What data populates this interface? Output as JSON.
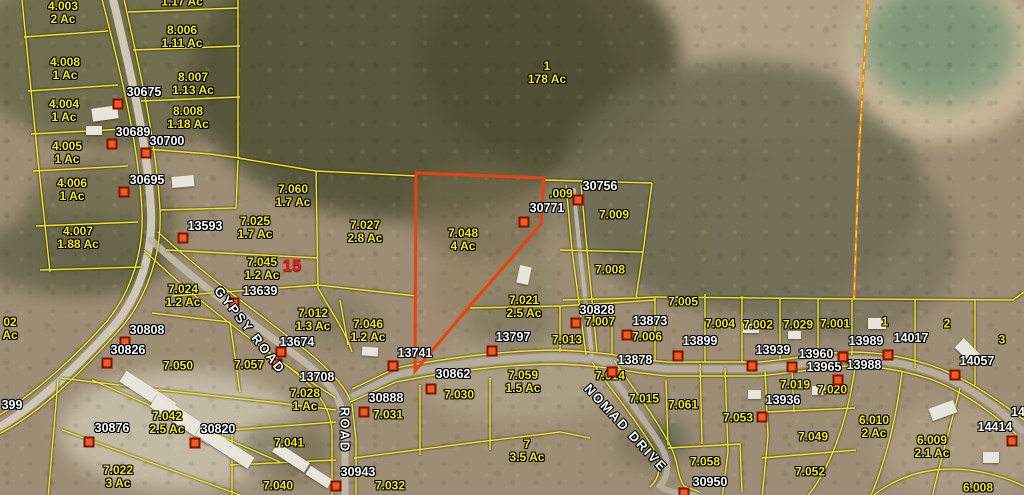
{
  "map": {
    "type": "county-gis-parcel-viewer",
    "highlight": {
      "parcel_num": "7.048",
      "outline_color": "#e8430e"
    },
    "colors": {
      "parcel_line": "#f0e822",
      "parcel_label": "#f6ee00",
      "id_label": "#ffffff",
      "marker_fill": "#f15b1e",
      "marker_border": "#7c1200",
      "route_label": "#ff1010",
      "section_line": "#e8821e",
      "pond": "#8ba081"
    },
    "parcels": [
      {
        "num": "4.003",
        "acres": "2 Ac",
        "x": 63,
        "y": 6
      },
      {
        "num": "4.008",
        "acres": "1 Ac",
        "x": 65,
        "y": 62
      },
      {
        "num": "4.004",
        "acres": "1 Ac",
        "x": 64,
        "y": 104
      },
      {
        "num": "4.005",
        "acres": "1 Ac",
        "x": 67,
        "y": 146
      },
      {
        "num": "4.006",
        "acres": "1 Ac",
        "x": 72,
        "y": 183
      },
      {
        "num": "4.007",
        "acres": "1.88 Ac",
        "x": 78,
        "y": 231
      },
      {
        "num": "",
        "acres": "1.17 Ac",
        "x": 182,
        "y": 2
      },
      {
        "num": "8.006",
        "acres": "1.11 Ac",
        "x": 182,
        "y": 30
      },
      {
        "num": "8.007",
        "acres": "1.13 Ac",
        "x": 193,
        "y": 77
      },
      {
        "num": "8.008",
        "acres": "1.18 Ac",
        "x": 188,
        "y": 111
      },
      {
        "num": "1",
        "acres": "178 Ac",
        "x": 547,
        "y": 66
      },
      {
        "num": "7.060",
        "acres": "1.7 Ac",
        "x": 293,
        "y": 189
      },
      {
        "num": "7.025",
        "acres": "1.7 Ac",
        "x": 255,
        "y": 221
      },
      {
        "num": "7.027",
        "acres": "2.8 Ac",
        "x": 365,
        "y": 225
      },
      {
        "num": "7.045",
        "acres": "1.2 Ac",
        "x": 262,
        "y": 262
      },
      {
        "num": "7.024",
        "acres": "1.2 Ac",
        "x": 183,
        "y": 289
      },
      {
        "num": "7.012",
        "acres": "1.3 Ac",
        "x": 313,
        "y": 313
      },
      {
        "num": "7.046",
        "acres": "1.2 Ac",
        "x": 368,
        "y": 324
      },
      {
        "num": "7.048",
        "acres": "4 Ac",
        "x": 463,
        "y": 233
      },
      {
        "num": "7.021",
        "acres": "2.5 Ac",
        "x": 524,
        "y": 300
      },
      {
        "num": ".009",
        "acres": "",
        "x": 561,
        "y": 194
      },
      {
        "num": "7.009",
        "acres": "",
        "x": 614,
        "y": 215
      },
      {
        "num": "7.008",
        "acres": "",
        "x": 610,
        "y": 270
      },
      {
        "num": "7.007",
        "acres": "",
        "x": 600,
        "y": 322
      },
      {
        "num": "7.006",
        "acres": "",
        "x": 647,
        "y": 337
      },
      {
        "num": "7.005",
        "acres": "",
        "x": 683,
        "y": 302
      },
      {
        "num": "7.004",
        "acres": "",
        "x": 720,
        "y": 324
      },
      {
        "num": "7.002",
        "acres": "",
        "x": 758,
        "y": 325
      },
      {
        "num": "7.029",
        "acres": "",
        "x": 798,
        "y": 325
      },
      {
        "num": "7.001",
        "acres": "",
        "x": 835,
        "y": 324
      },
      {
        "num": "1",
        "acres": "",
        "x": 885,
        "y": 322
      },
      {
        "num": "2",
        "acres": "",
        "x": 947,
        "y": 324
      },
      {
        "num": "3",
        "acres": "",
        "x": 1002,
        "y": 340
      },
      {
        "num": "7.013",
        "acres": "",
        "x": 567,
        "y": 340
      },
      {
        "num": "7.014",
        "acres": "",
        "x": 610,
        "y": 376
      },
      {
        "num": "7.015",
        "acres": "",
        "x": 644,
        "y": 399
      },
      {
        "num": "7.061",
        "acres": "",
        "x": 683,
        "y": 405
      },
      {
        "num": "7.059",
        "acres": "1.5 Ac",
        "x": 523,
        "y": 375
      },
      {
        "num": "7.030",
        "acres": "",
        "x": 459,
        "y": 395
      },
      {
        "num": "7.031",
        "acres": "",
        "x": 388,
        "y": 415
      },
      {
        "num": "7.028",
        "acres": "1 Ac",
        "x": 305,
        "y": 393
      },
      {
        "num": "7.057",
        "acres": "",
        "x": 249,
        "y": 365
      },
      {
        "num": "7.050",
        "acres": "",
        "x": 178,
        "y": 366
      },
      {
        "num": "7.041",
        "acres": "",
        "x": 289,
        "y": 443
      },
      {
        "num": "7.040",
        "acres": "",
        "x": 278,
        "y": 486
      },
      {
        "num": "7.032",
        "acres": "",
        "x": 390,
        "y": 486
      },
      {
        "num": "7.022",
        "acres": "3 Ac",
        "x": 118,
        "y": 470
      },
      {
        "num": "7.042",
        "acres": "2.5 Ac",
        "x": 167,
        "y": 416
      },
      {
        "num": "7",
        "acres": "3.5 Ac",
        "x": 527,
        "y": 444
      },
      {
        "num": "7.058",
        "acres": "",
        "x": 705,
        "y": 462
      },
      {
        "num": "7.053",
        "acres": "",
        "x": 738,
        "y": 418
      },
      {
        "num": "7.019",
        "acres": "",
        "x": 795,
        "y": 385
      },
      {
        "num": "7.020",
        "acres": "",
        "x": 832,
        "y": 390
      },
      {
        "num": "7.049",
        "acres": "",
        "x": 813,
        "y": 437
      },
      {
        "num": "7.052",
        "acres": "",
        "x": 810,
        "y": 472
      },
      {
        "num": "6.010",
        "acres": "2 Ac",
        "x": 874,
        "y": 420
      },
      {
        "num": "6.009",
        "acres": "2.1 Ac",
        "x": 932,
        "y": 440
      },
      {
        "num": "6.008",
        "acres": "",
        "x": 978,
        "y": 488
      },
      {
        "num": "02",
        "acres": "Ac",
        "x": 10,
        "y": 322
      }
    ],
    "markers": [
      {
        "id": "30675",
        "lx": 144,
        "ly": 92,
        "mx": 118,
        "my": 104
      },
      {
        "id": "30689",
        "lx": 133,
        "ly": 132,
        "mx": 112,
        "my": 144
      },
      {
        "id": "30700",
        "lx": 167,
        "ly": 141,
        "mx": 146,
        "my": 153
      },
      {
        "id": "30695",
        "lx": 147,
        "ly": 180,
        "mx": 124,
        "my": 192
      },
      {
        "id": "13593",
        "lx": 205,
        "ly": 226,
        "mx": 183,
        "my": 238
      },
      {
        "id": "13639",
        "lx": 260,
        "ly": 291,
        "mx": 234,
        "my": 303
      },
      {
        "id": "13674",
        "lx": 297,
        "ly": 342,
        "mx": 281,
        "my": 352
      },
      {
        "id": "30808",
        "lx": 147,
        "ly": 330,
        "mx": 125,
        "my": 342
      },
      {
        "id": "30826",
        "lx": 128,
        "ly": 350,
        "mx": 107,
        "my": 363
      },
      {
        "id": "30756",
        "lx": 600,
        "ly": 186,
        "mx": 578,
        "my": 200
      },
      {
        "id": "30771",
        "lx": 547,
        "ly": 208,
        "mx": 524,
        "my": 222
      },
      {
        "id": "30828",
        "lx": 597,
        "ly": 310,
        "mx": 576,
        "my": 323
      },
      {
        "id": "13873",
        "lx": 650,
        "ly": 321,
        "mx": 627,
        "my": 335
      },
      {
        "id": "13899",
        "lx": 700,
        "ly": 341,
        "mx": 678,
        "my": 356
      },
      {
        "id": "13878",
        "lx": 635,
        "ly": 360,
        "mx": 612,
        "my": 372
      },
      {
        "id": "13797",
        "lx": 513,
        "ly": 337,
        "mx": 492,
        "my": 351
      },
      {
        "id": "13741",
        "lx": 415,
        "ly": 353,
        "mx": 393,
        "my": 366
      },
      {
        "id": "13708",
        "lx": 317,
        "ly": 377,
        "mx": 277,
        "my": 364
      },
      {
        "id": "30862",
        "lx": 453,
        "ly": 374,
        "mx": 431,
        "my": 389
      },
      {
        "id": "30888",
        "lx": 386,
        "ly": 398,
        "mx": 364,
        "my": 412
      },
      {
        "id": "30943",
        "lx": 358,
        "ly": 472,
        "mx": 336,
        "my": 486
      },
      {
        "id": "30876",
        "lx": 112,
        "ly": 428,
        "mx": 89,
        "my": 442
      },
      {
        "id": "30820",
        "lx": 218,
        "ly": 429,
        "mx": 195,
        "my": 443
      },
      {
        "id": "30950",
        "lx": 710,
        "ly": 482,
        "mx": 684,
        "my": 493
      },
      {
        "id": "13936",
        "lx": 783,
        "ly": 400,
        "mx": 762,
        "my": 417
      },
      {
        "id": "13939",
        "lx": 773,
        "ly": 350,
        "mx": 752,
        "my": 366
      },
      {
        "id": "13960",
        "lx": 816,
        "ly": 354,
        "mx": 792,
        "my": 367
      },
      {
        "id": "13965",
        "lx": 824,
        "ly": 367,
        "mx": 838,
        "my": 380
      },
      {
        "id": "13988",
        "lx": 864,
        "ly": 365,
        "mx": null,
        "my": null
      },
      {
        "id": "13989",
        "lx": 866,
        "ly": 341,
        "mx": 843,
        "my": 357
      },
      {
        "id": "14017",
        "lx": 911,
        "ly": 338,
        "mx": 888,
        "my": 355
      },
      {
        "id": "14057",
        "lx": 977,
        "ly": 361,
        "mx": 955,
        "my": 375
      },
      {
        "id": "14414",
        "lx": 995,
        "ly": 427,
        "mx": 1012,
        "my": 441
      },
      {
        "id": "399",
        "lx": 12,
        "ly": 405,
        "mx": null,
        "my": null
      },
      {
        "id": "14",
        "lx": 1018,
        "ly": 412,
        "mx": null,
        "my": null
      }
    ],
    "road_labels": [
      {
        "name": "GYPSY ROAD",
        "x": 250,
        "y": 330,
        "rot": 52
      },
      {
        "name": "ROAD",
        "x": 345,
        "y": 430,
        "rot": 90
      },
      {
        "name": "NOMAD DRIVE",
        "x": 626,
        "y": 428,
        "rot": 47
      }
    ],
    "route_markers": [
      {
        "text": "15",
        "x": 292,
        "y": 266
      }
    ]
  }
}
